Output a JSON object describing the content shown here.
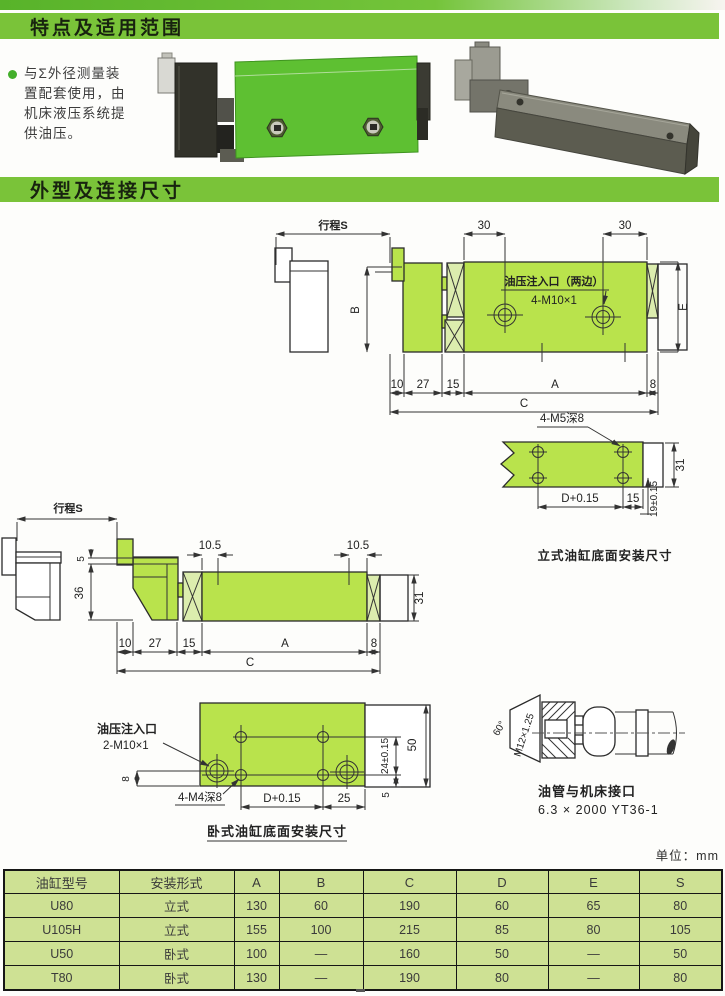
{
  "header": {
    "section1": "特点及适用范围",
    "section2": "外型及连接尺寸"
  },
  "intro": {
    "lines": [
      "与Σ外径测量装",
      "置配套使用，由",
      "机床液压系统提",
      "供油压。"
    ]
  },
  "vertical_side": {
    "stroke": "行程S",
    "d30a": "30",
    "d30b": "30",
    "port_title": "油压注入口（两边）",
    "port_thread": "4-M10×1",
    "dimB": "B",
    "dimE": "E",
    "bottom": [
      "10",
      "27",
      "15",
      "A",
      "8"
    ],
    "dimC": "C"
  },
  "vertical_bottom": {
    "thread": "4-M5深8",
    "dimD": "D+0.15",
    "d15": "15",
    "d31": "31",
    "d19": "19±0.15",
    "caption": "立式油缸底面安装尺寸"
  },
  "horizontal_side": {
    "stroke": "行程S",
    "d5": "5",
    "d36": "36",
    "d105a": "10.5",
    "d105b": "10.5",
    "d31": "31",
    "bottom": [
      "10",
      "27",
      "15",
      "A",
      "8"
    ],
    "dimC": "C"
  },
  "horizontal_bottom": {
    "port_title": "油压注入口",
    "port_thread": "2-M10×1",
    "d8": "8",
    "thread": "4-M4深8",
    "dimD": "D+0.15",
    "d25": "25",
    "d24": "24±0.15",
    "d5": "5",
    "d50": "50",
    "caption": "卧式油缸底面安装尺寸"
  },
  "fitting": {
    "angle": "60°",
    "thread": "M12×1.25",
    "caption1": "油管与机床接口",
    "caption2": "6.3 × 2000 YT36-1"
  },
  "table": {
    "unit": "单位：mm",
    "headers": [
      "油缸型号",
      "安装形式",
      "A",
      "B",
      "C",
      "D",
      "E",
      "S"
    ],
    "rows": [
      [
        "U80",
        "立式",
        "130",
        "60",
        "190",
        "60",
        "65",
        "80"
      ],
      [
        "U105H",
        "立式",
        "155",
        "100",
        "215",
        "85",
        "80",
        "105"
      ],
      [
        "U50",
        "卧式",
        "100",
        "—",
        "160",
        "50",
        "—",
        "50"
      ],
      [
        "T80",
        "卧式",
        "130",
        "—",
        "190",
        "80",
        "—",
        "80"
      ]
    ]
  },
  "colors": {
    "band_green": "#7ac339",
    "drawing_green": "#b9e34c",
    "table_green": "#cee194",
    "photo_green": "#5ec032"
  }
}
